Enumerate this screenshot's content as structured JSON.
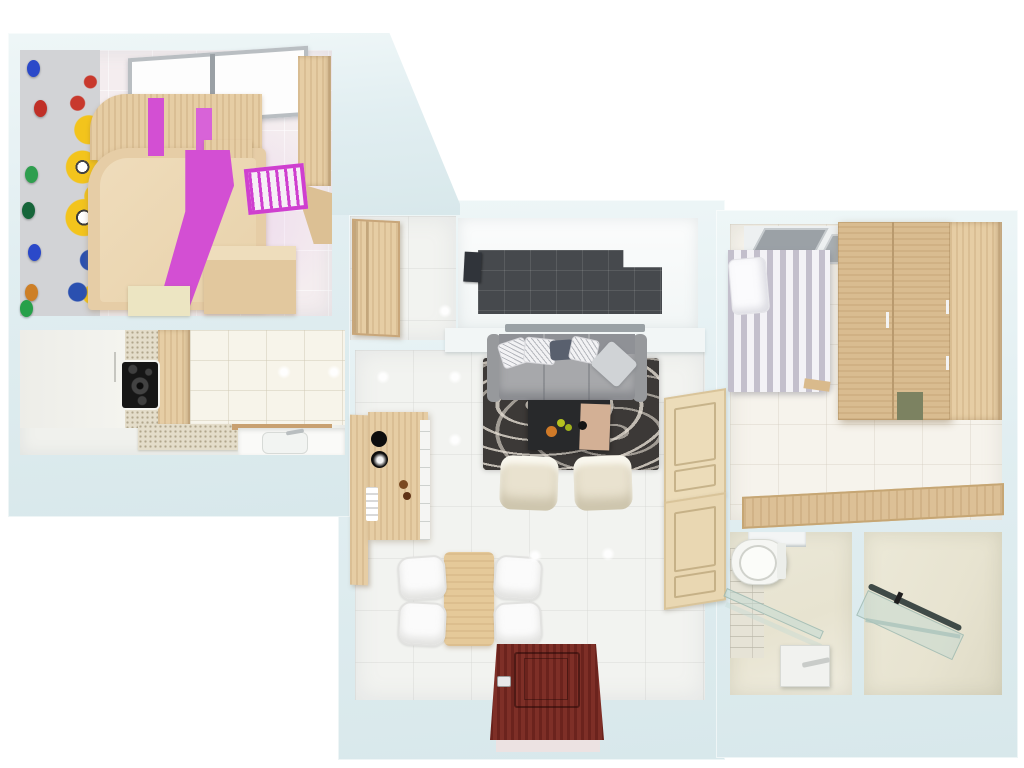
{
  "scene": {
    "description": "3D top-down dollhouse render of a one-bedroom apartment floor plan",
    "view": "top-down perspective",
    "background_color": "#ffffff",
    "wall_color": "#e3eff1"
  },
  "rooms": [
    {
      "id": "kids-bedroom",
      "position": "top-left",
      "features": [
        "minions-wallpaper",
        "string-light-garland",
        "window",
        "magenta-wardrobe-band",
        "wood-cabinets",
        "bed",
        "pink-crib",
        "wood-desk",
        "dresser",
        "pink-tinted-tile-floor"
      ]
    },
    {
      "id": "kitchen",
      "position": "middle-left",
      "features": [
        "white-wall-cabinets",
        "speckled-backsplash",
        "black-cooktop",
        "tall-wood-cabinet",
        "white-tile-wall",
        "speckled-countertop",
        "sink-with-faucet"
      ]
    },
    {
      "id": "hallway-niche",
      "position": "top-center-left",
      "features": [
        "wood-door-leaf"
      ]
    },
    {
      "id": "balcony-loggia",
      "position": "top-center",
      "features": [
        "dark-gray-tile-floor",
        "wall-unit",
        "window-sill-band"
      ]
    },
    {
      "id": "living-room",
      "position": "center",
      "features": [
        "gray-sofa-with-pillows",
        "dark-swirl-rug",
        "black-coffee-table",
        "wood-tray",
        "two-cream-armchairs",
        "wood-bar-shelf-unit",
        "dining-table",
        "four-white-chairs",
        "entry-door-dark-red",
        "two-beige-panel-doors"
      ]
    },
    {
      "id": "bedroom",
      "position": "top-right",
      "features": [
        "window",
        "striped-duvet-bed",
        "white-pillow",
        "large-wood-wardrobe",
        "wood-floor-runner"
      ]
    },
    {
      "id": "wc",
      "position": "bottom-right-inner",
      "features": [
        "toilet",
        "brick-tile-wall",
        "glass-shelf",
        "white-sink-cabinet",
        "mirror-band"
      ]
    },
    {
      "id": "bathroom",
      "position": "bottom-right-outer",
      "features": [
        "glass-shower-screen",
        "dark-rail",
        "glass-shelf"
      ]
    }
  ],
  "palette": {
    "wall": "#e3eff1",
    "wood_light": "#e6cda4",
    "wood_mid": "#d9bc90",
    "magenta": "#d34fd3",
    "sofa_gray": "#a0a1a4",
    "rug_dark": "#3c3937",
    "balcony_tile": "#46494d",
    "entry_door_red": "#74261f",
    "duvet_stripe": "#c3bfcc",
    "bathroom_beige": "#e9e6d4",
    "minion_yellow": "#f3c41c",
    "garland_colors": [
      "#2b49c9",
      "#c03028",
      "#2f9e4f",
      "#17653a",
      "#2b49c9",
      "#cd7f27",
      "#27a04a"
    ]
  }
}
